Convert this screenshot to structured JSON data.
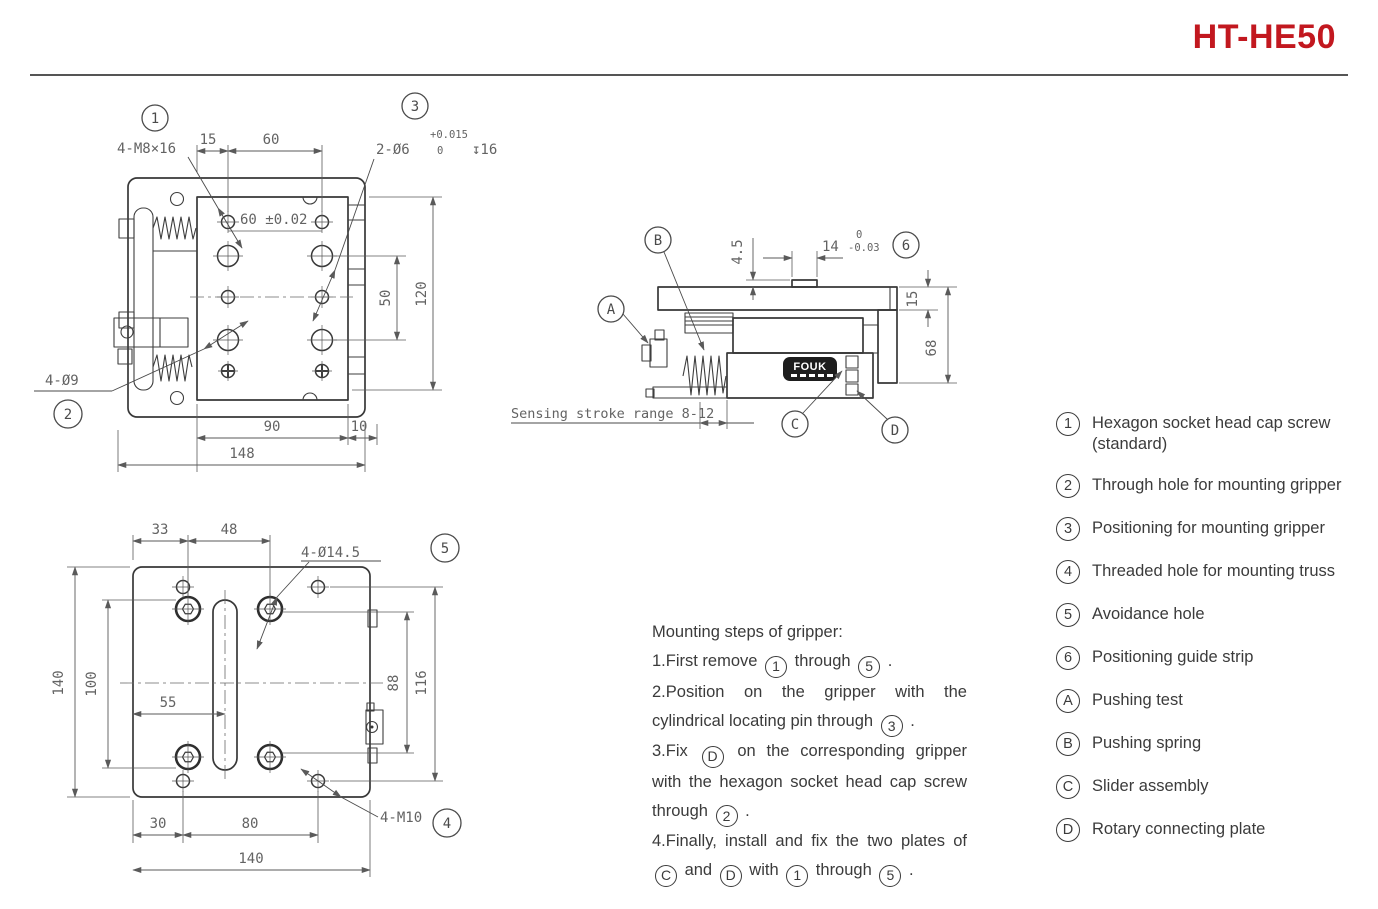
{
  "title": "HT-HE50",
  "colors": {
    "accent": "#C2181F",
    "line": "#383838",
    "dim_text": "#636363"
  },
  "front": {
    "callout_1": "1",
    "callout_2": "2",
    "callout_3": "3",
    "label_m8": "4-M8×16",
    "dim_15": "15",
    "dim_60_top": "60",
    "label_2d6": "2-Ø6",
    "tol_upper": "+0.015",
    "tol_lower": "0",
    "depth_16": "↧16",
    "dim_60_tol": "60 ±0.02",
    "dim_50": "50",
    "dim_120": "120",
    "dim_90": "90",
    "dim_10": "10",
    "dim_148": "148",
    "label_4d9": "4-Ø9"
  },
  "side": {
    "callout_a": "A",
    "callout_b": "B",
    "callout_c": "C",
    "callout_d": "D",
    "callout_6": "6",
    "dim_45": "4.5",
    "dim_14": "14",
    "tol_upper": "0",
    "tol_lower": "-0.03",
    "dim_15": "15",
    "dim_68": "68",
    "stroke_note": "Sensing stroke range 8-12",
    "logo": "FOUK"
  },
  "bottom": {
    "callout_4": "4",
    "callout_5": "5",
    "dim_33": "33",
    "dim_48": "48",
    "label_4d145": "4-Ø14.5",
    "dim_140_left": "140",
    "dim_100": "100",
    "dim_55": "55",
    "dim_88": "88",
    "dim_116": "116",
    "dim_30": "30",
    "dim_80": "80",
    "dim_140_bottom": "140",
    "label_4m10": "4-M10"
  },
  "steps": {
    "heading": "Mounting steps of gripper:",
    "items": [
      "1.First remove {1} through {5} .",
      "2.Position on the gripper with the cylindrical locating pin through {3} .",
      "3.Fix {D} on the corresponding gripper with the hexagon socket head cap screw through {2} .",
      "4.Finally, install and fix the two plates of {C} and {D} with {1} through {5} ."
    ]
  },
  "legend": [
    {
      "symbol": "1",
      "label": "Hexagon socket head cap screw (standard)"
    },
    {
      "symbol": "2",
      "label": "Through hole for mounting gripper"
    },
    {
      "symbol": "3",
      "label": "Positioning for mounting gripper"
    },
    {
      "symbol": "4",
      "label": "Threaded hole for mounting truss"
    },
    {
      "symbol": "5",
      "label": "Avoidance hole"
    },
    {
      "symbol": "6",
      "label": "Positioning guide strip"
    },
    {
      "symbol": "A",
      "label": "Pushing test"
    },
    {
      "symbol": "B",
      "label": "Pushing spring"
    },
    {
      "symbol": "C",
      "label": "Slider assembly"
    },
    {
      "symbol": "D",
      "label": "Rotary connecting plate"
    }
  ]
}
